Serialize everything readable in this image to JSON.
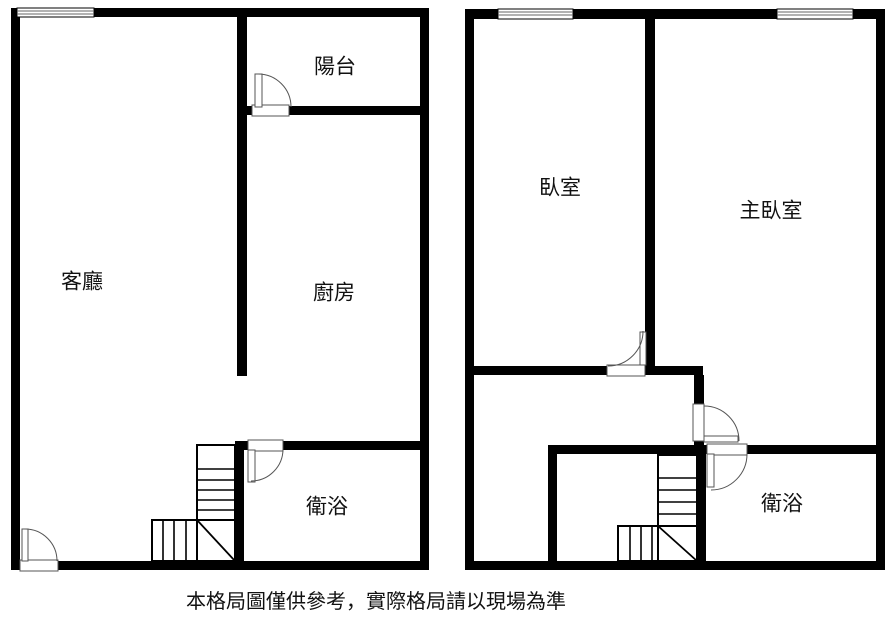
{
  "caption": "本格局圖僅供參考，實際格局請以現場為準",
  "colors": {
    "wall": "#000000",
    "background": "#ffffff",
    "door_line": "#555555"
  },
  "floor1": {
    "rooms": {
      "balcony": "陽台",
      "living_room": "客廳",
      "kitchen": "廚房",
      "bathroom": "衛浴"
    }
  },
  "floor2": {
    "rooms": {
      "bedroom": "臥室",
      "master_bedroom": "主臥室",
      "bathroom": "衛浴"
    }
  }
}
